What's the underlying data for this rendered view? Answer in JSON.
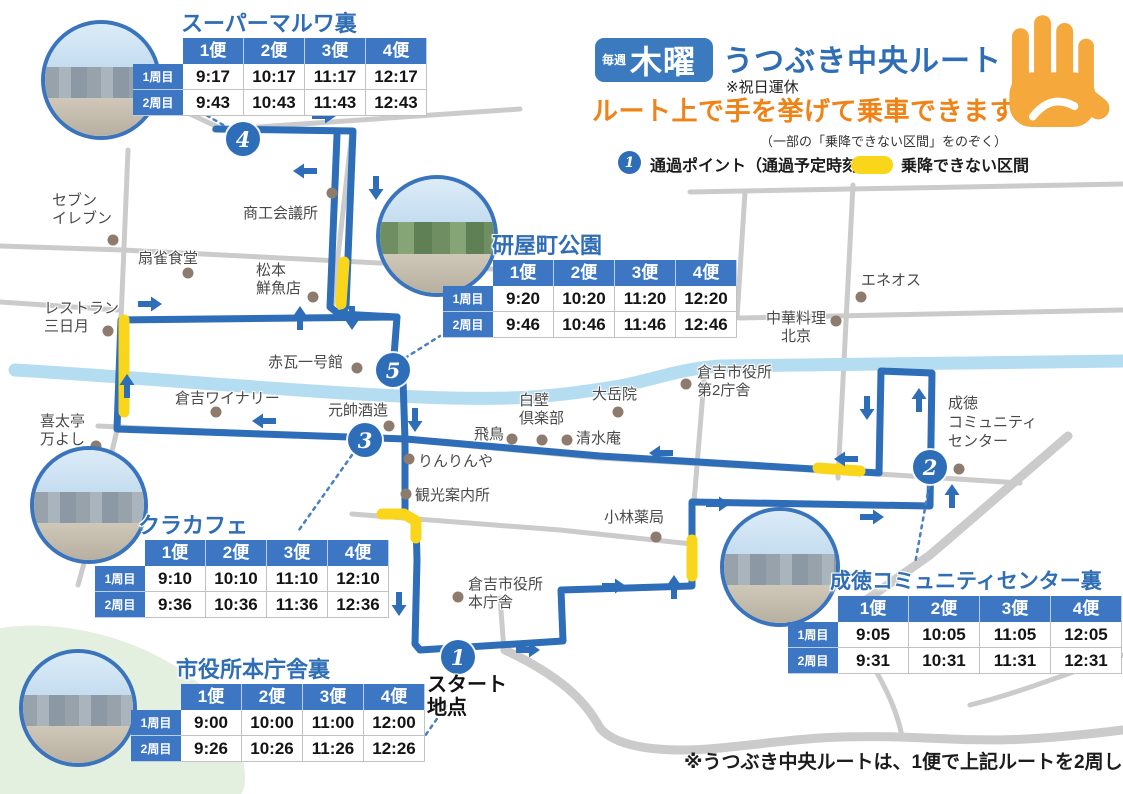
{
  "colors": {
    "route_blue": "#2e6db8",
    "table_header_blue": "#3d77c4",
    "title_blue": "#2f6eb4",
    "no_board_yellow": "#f9d61a",
    "banner_orange": "#ef8318",
    "hand_orange": "#f5a83b",
    "road_gray": "#cbcbcb",
    "river_blue": "#b5ddf1"
  },
  "header": {
    "badge_small": "毎週",
    "badge_large": "木曜",
    "title": "うつぶき中央ルート",
    "holiday_note": "※祝日運休",
    "banner": "ルート上で手を挙げて乗車できます",
    "banner_note": "（一部の「乗降できない区間」をのぞく）",
    "legend_point_number": "1",
    "legend_point_label": "通過ポイント（通過予定時刻）",
    "legend_noboard_label": "乗降できない区間"
  },
  "start_point_label": "スタート\n地点",
  "footer_note": "※うつぶき中央ルートは、1便で上記ルートを2周します",
  "stop_numbers": [
    "1",
    "2",
    "3",
    "4",
    "5"
  ],
  "timetables": [
    {
      "title": "スーパーマルワ裏",
      "columns": [
        "1便",
        "2便",
        "3便",
        "4便"
      ],
      "rows": [
        {
          "label": "1周目",
          "times": [
            "9:17",
            "10:17",
            "11:17",
            "12:17"
          ]
        },
        {
          "label": "2周目",
          "times": [
            "9:43",
            "10:43",
            "11:43",
            "12:43"
          ]
        }
      ]
    },
    {
      "title": "研屋町公園",
      "columns": [
        "1便",
        "2便",
        "3便",
        "4便"
      ],
      "rows": [
        {
          "label": "1周目",
          "times": [
            "9:20",
            "10:20",
            "11:20",
            "12:20"
          ]
        },
        {
          "label": "2周目",
          "times": [
            "9:46",
            "10:46",
            "11:46",
            "12:46"
          ]
        }
      ]
    },
    {
      "title": "クラカフェ",
      "columns": [
        "1便",
        "2便",
        "3便",
        "4便"
      ],
      "rows": [
        {
          "label": "1周目",
          "times": [
            "9:10",
            "10:10",
            "11:10",
            "12:10"
          ]
        },
        {
          "label": "2周目",
          "times": [
            "9:36",
            "10:36",
            "11:36",
            "12:36"
          ]
        }
      ]
    },
    {
      "title": "市役所本庁舎裏",
      "columns": [
        "1便",
        "2便",
        "3便",
        "4便"
      ],
      "rows": [
        {
          "label": "1周目",
          "times": [
            "9:00",
            "10:00",
            "11:00",
            "12:00"
          ]
        },
        {
          "label": "2周目",
          "times": [
            "9:26",
            "10:26",
            "11:26",
            "12:26"
          ]
        }
      ]
    },
    {
      "title": "成徳コミュニティセンター裏",
      "columns": [
        "1便",
        "2便",
        "3便",
        "4便"
      ],
      "rows": [
        {
          "label": "1周目",
          "times": [
            "9:05",
            "10:05",
            "11:05",
            "12:05"
          ]
        },
        {
          "label": "2周目",
          "times": [
            "9:31",
            "10:31",
            "11:31",
            "12:31"
          ]
        }
      ]
    }
  ],
  "places": [
    "セブン\nイレブン",
    "商工会議所",
    "扇雀食堂",
    "松本\n鮮魚店",
    "レストラン\n三日月",
    "赤瓦一号館",
    "倉吉ワイナリー",
    "喜太亭\n万よし",
    "元帥酒造",
    "白壁\n倶楽部",
    "飛鳥",
    "大岳院",
    "清水庵",
    "りんりんや",
    "観光案内所",
    "小林薬局",
    "倉吉市役所\n本庁舎",
    "倉吉市役所\n第2庁舎",
    "中華料理\n北京",
    "エネオス",
    "成徳\nコミュニティ\nセンター"
  ]
}
